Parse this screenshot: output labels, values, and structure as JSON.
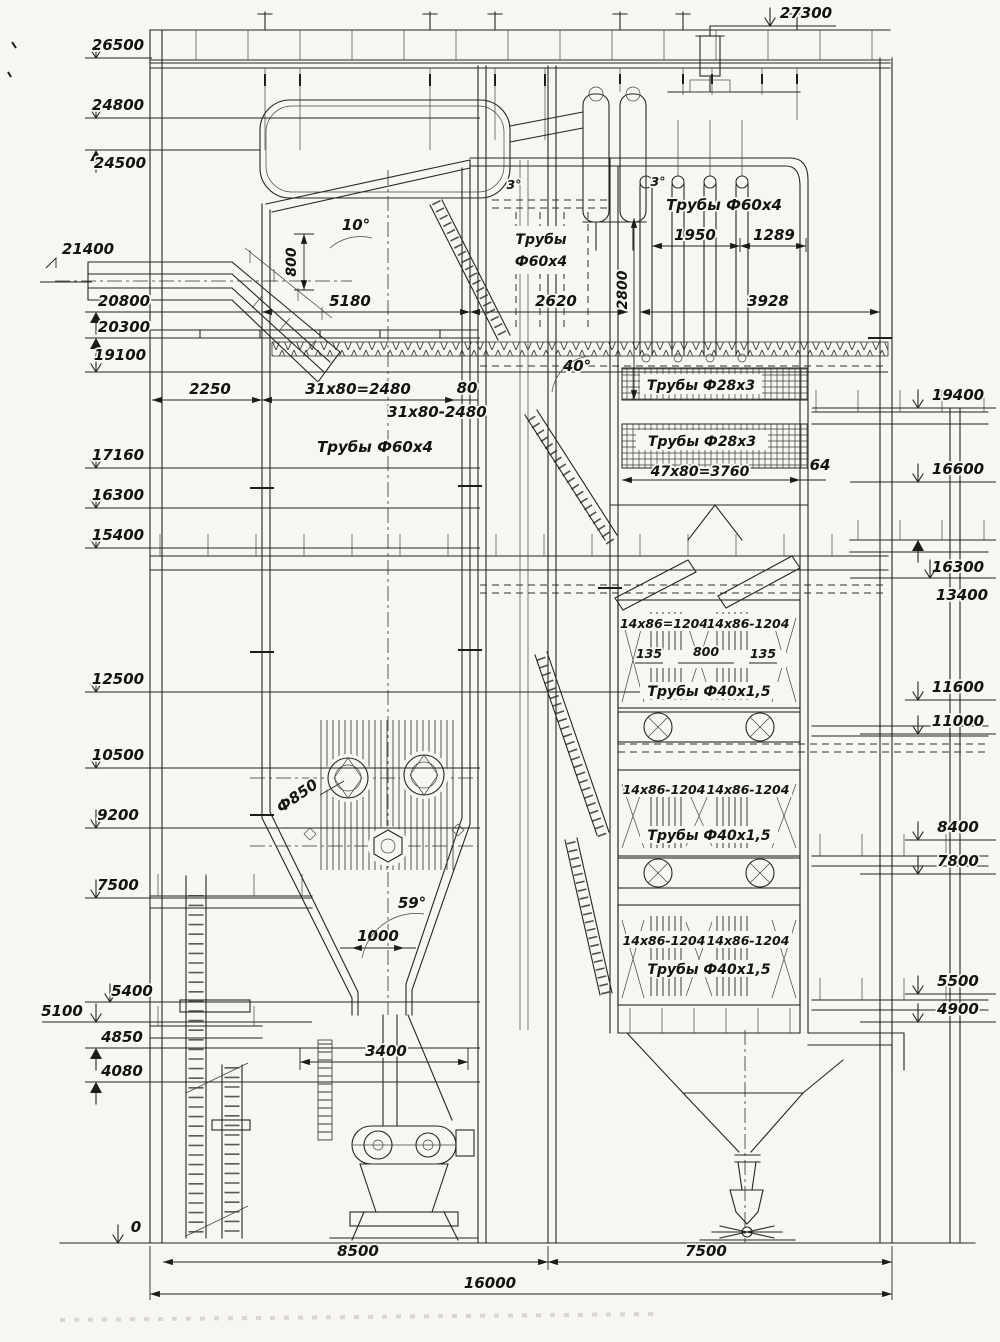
{
  "annotations": {
    "elev_top": "27300",
    "elev_left": [
      "26500",
      "24800",
      "24500",
      "21400",
      "20800",
      "20300",
      "19100",
      "17160",
      "16300",
      "15400",
      "12500",
      "10500",
      "9200",
      "7500",
      "5400",
      "5100",
      "4850",
      "4080",
      "0"
    ],
    "elev_right": [
      "19400",
      "16600",
      "16300",
      "13400",
      "11600",
      "11000",
      "8400",
      "7800",
      "5500",
      "4900"
    ],
    "angles": {
      "roof": "10°",
      "slope_a": "3°",
      "slope_b": "3°",
      "gas_turn": "40°",
      "funnel": "59°"
    },
    "dims": {
      "roof_drop": "800",
      "furnace_width": "5180",
      "pass_width": "2620",
      "platen_height": "2800",
      "platen_a": "1950",
      "platen_b": "1289",
      "shaft_width": "3928",
      "col_gap": "2250",
      "row_pitch_eq": "31х80=2480",
      "row_gap": "80",
      "row_pitch": "31х80-2480",
      "bundle_pitch": "47х80=3760",
      "wall_gap": "64",
      "econ_pitch_eq": "14х86=1204",
      "econ_pitch": "14х86-1204",
      "econ_gap_side": "135",
      "econ_gap_mid": "800",
      "throat": "1000",
      "burner_dia": "Ф850",
      "mill_width": "3400",
      "span_left": "8500",
      "span_right": "7500",
      "span_total": "16000"
    },
    "tubes": {
      "furnace": "Трубы Ф60х4",
      "platen_l1": "Трубы",
      "platen_l2": "Ф60х4",
      "platen_right": "Трубы Ф60х4",
      "shb_upper": "Трубы Ф28х3",
      "shb_lower": "Трубы Ф28х3",
      "econ": "Трубы Ф40х1,5"
    }
  }
}
